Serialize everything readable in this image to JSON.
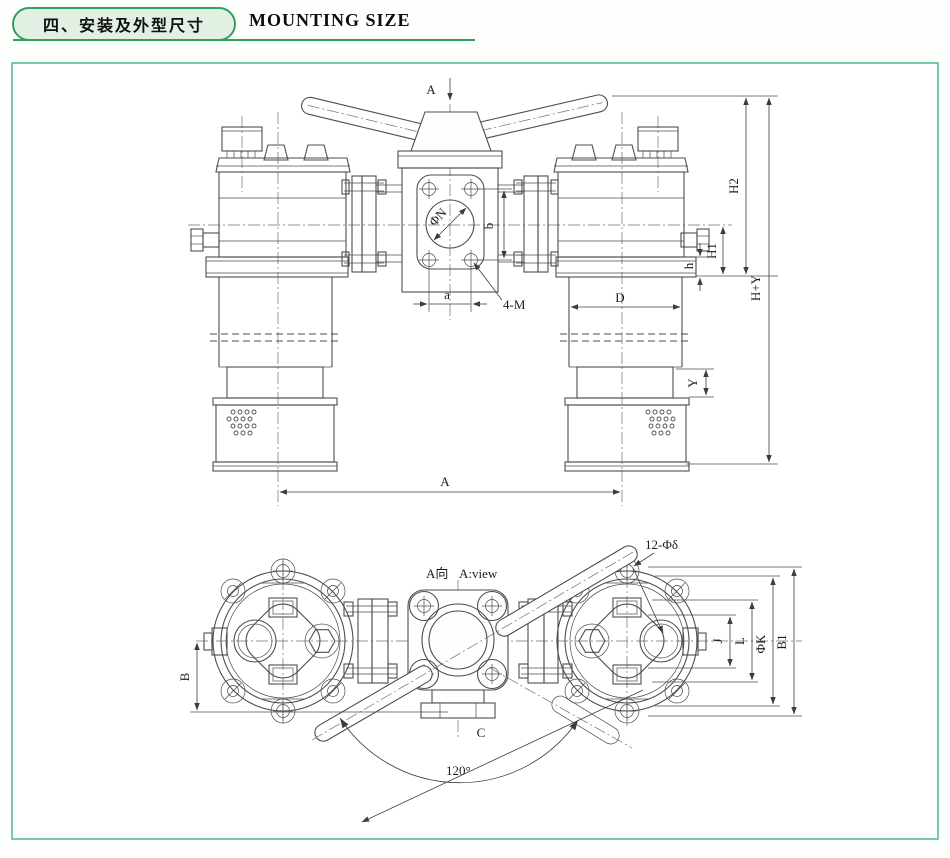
{
  "header": {
    "section_cn": "四、安装及外型尺寸",
    "section_en": "MOUNTING SIZE"
  },
  "colors": {
    "green_accent": "#2f9e5e",
    "frame_green": "#57bd92",
    "pill_fill": "#e2f0e4",
    "line_gray": "#4d4d4d"
  },
  "front_view": {
    "view_arrow_label": "A",
    "labels": {
      "phi_n": "ΦN",
      "a": "a",
      "b": "b",
      "four_m": "4-M",
      "d": "D",
      "y": "Y",
      "h2": "H2",
      "h1": "H1",
      "h": "h",
      "h_plus_y": "H+Y",
      "a_span": "A"
    }
  },
  "a_view": {
    "title_cn": "A向",
    "title_en": "A:view",
    "labels": {
      "twelve_phi": "12-Φδ",
      "b": "B",
      "c": "C",
      "angle": "120°",
      "j": "J",
      "l": "L",
      "phi_k": "ΦK",
      "b1": "B1"
    }
  }
}
